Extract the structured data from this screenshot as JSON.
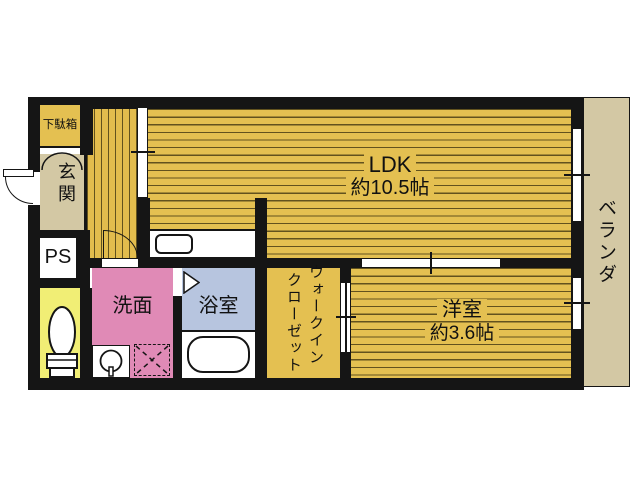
{
  "rooms": {
    "ldk": {
      "name": "LDK",
      "size": "約10.5帖"
    },
    "western": {
      "name": "洋室",
      "size": "約3.6帖"
    },
    "washroom": {
      "name": "洗面"
    },
    "bathroom": {
      "name": "浴室"
    },
    "wic": {
      "line1": "ウォークイン",
      "line2": "クローゼット"
    },
    "veranda": {
      "name": "ベランダ"
    },
    "entrance": {
      "name": "玄関"
    },
    "shoebox": {
      "name": "下駄箱"
    },
    "pipespace": {
      "name": "PS"
    }
  },
  "colors": {
    "flooring": "#e4c051",
    "stripe": "#544618",
    "tatami_beige": "#d3c8a4",
    "washroom_pink": "#e08ab6",
    "bathroom_blue": "#b7c5df",
    "toilet_yellow": "#f1ee75",
    "wall": "#151515",
    "fixture_white": "#ffffff"
  }
}
